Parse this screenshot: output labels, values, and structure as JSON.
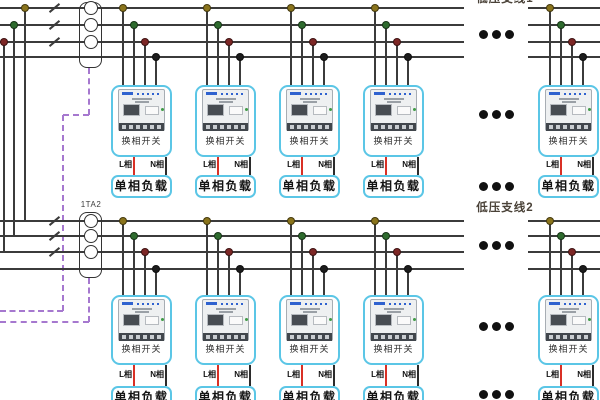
{
  "diagram": {
    "sections": [
      {
        "branch_label": "低压支线1",
        "ct_label": ""
      },
      {
        "branch_label": "低压支线2",
        "ct_label": "1TA2"
      }
    ],
    "device": {
      "phase_switch_label": "换相开关",
      "load_label": "单相负载",
      "l_phase_label": "L相",
      "n_phase_label": "N相"
    },
    "legend_colors": {
      "phase_a_dot": "#8a741c",
      "phase_b_dot": "#2e6b2e",
      "phase_c_dot": "#7d2726",
      "neutral_dot": "#1c1c1c",
      "l_wire": "#d93025",
      "n_wire": "#2b2b2b",
      "device_box_border": "#5bc6e6",
      "signal_cable": "#a678cf",
      "bus_line": "#3b3b3b",
      "ellipsis_dot": "#111111"
    }
  }
}
